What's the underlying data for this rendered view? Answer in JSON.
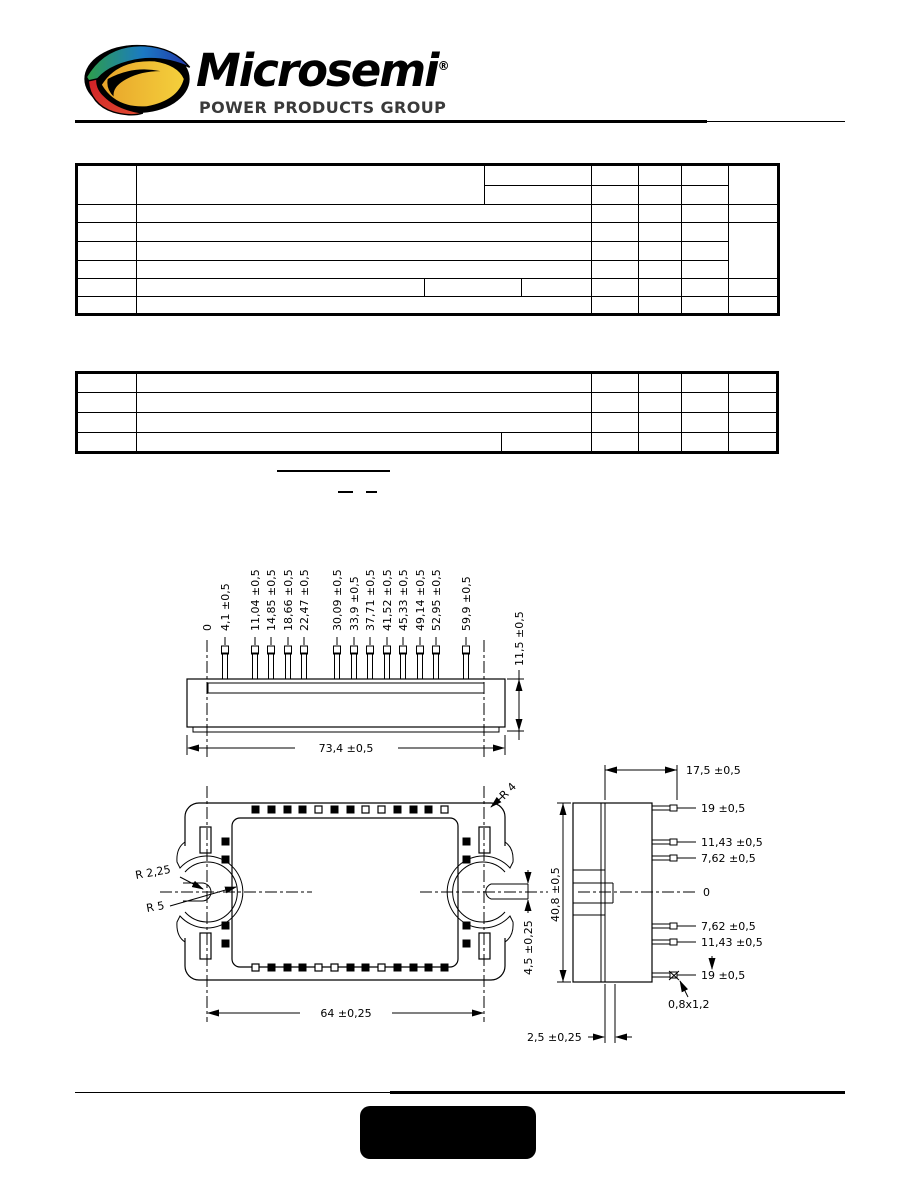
{
  "header": {
    "brand": "Microsemi",
    "registered": "®",
    "tagline": "POWER PRODUCTS GROUP",
    "logo_colors": {
      "green": "#2e9e49",
      "blue": "#1f4fa8",
      "red": "#cf2027",
      "gold": "#f0b42c"
    }
  },
  "drawing": {
    "front_view": {
      "pin_labels": [
        "0",
        "4,1 ±0,5",
        "11,04 ±0,5",
        "14,85 ±0,5",
        "18,66 ±0,5",
        "22,47 ±0,5",
        "30,09 ±0,5",
        "33,9 ±0,5",
        "37,71 ±0,5",
        "41,52 ±0,5",
        "45,33 ±0,5",
        "49,14 ±0,5",
        "52,95 ±0,5",
        "59,9 ±0,5"
      ],
      "body_height_label": "11,5 ±0,5",
      "body_width_label": "73,4 ±0,5"
    },
    "bottom_view": {
      "corner_radius_label": "R 4",
      "notch_inner_radius_label": "R 2,25",
      "notch_outer_radius_label": "R 5",
      "tab_height_label": "4,5 ±0,25",
      "hole_pitch_label": "64 ±0,25"
    },
    "side_view": {
      "top_width_label": "17,5 ±0,5",
      "pin_labels": [
        "19 ±0,5",
        "11,43 ±0,5",
        "7,62 ±0,5",
        "0",
        "7,62 ±0,5",
        "11,43 ±0,5",
        "19 ±0,5"
      ],
      "pin_cross_section_label": "0,8x1,2",
      "height_label": "40,8 ±0,5",
      "baseplate_label": "2,5 ±0,25"
    }
  }
}
